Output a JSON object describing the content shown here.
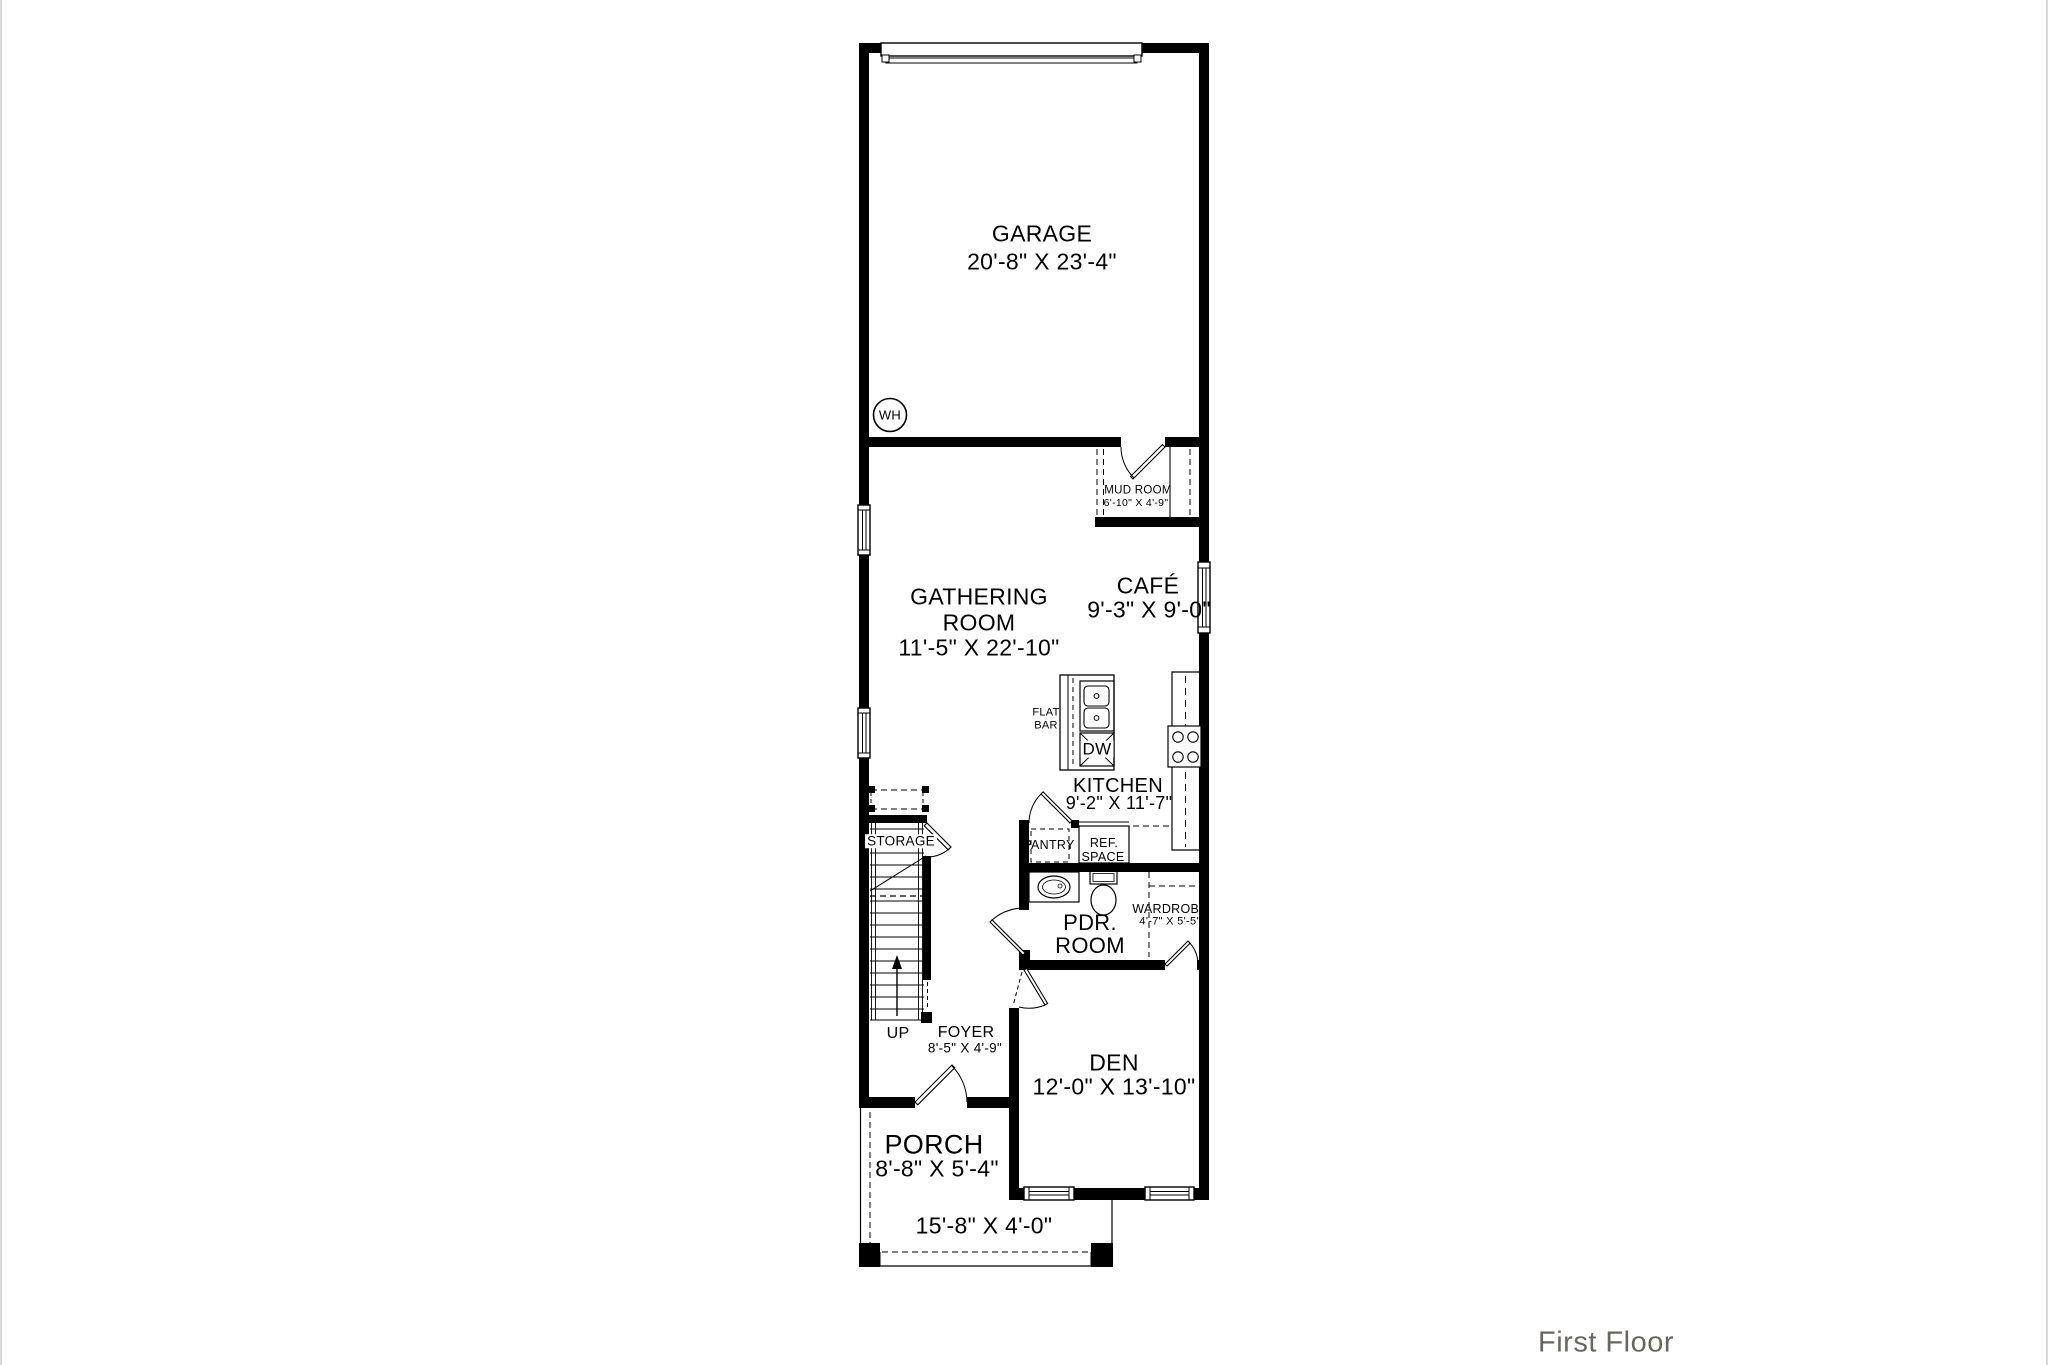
{
  "rooms": {
    "garage": {
      "name": "GARAGE",
      "dims": "20'-8\" X 23'-4\""
    },
    "gathering": {
      "line1": "GATHERING",
      "line2": "ROOM",
      "dims": "11'-5\" X 22'-10\""
    },
    "cafe": {
      "name": "CAFÉ",
      "dims": "9'-3\" X 9'-0\""
    },
    "mud_room": {
      "name": "MUD ROOM",
      "dims": "6'-10\" X 4'-9\""
    },
    "kitchen": {
      "name": "KITCHEN",
      "dims": "9'-2\" X 11'-7\""
    },
    "flat_bar": {
      "line1": "FLAT",
      "line2": "BAR"
    },
    "pantry": {
      "name": "PANTRY"
    },
    "ref_space": {
      "line1": "REF.",
      "line2": "SPACE"
    },
    "pdr_room": {
      "line1": "PDR.",
      "line2": "ROOM"
    },
    "wardrobe": {
      "name": "WARDROBE",
      "dims": "4'-7\" X 5'-5\""
    },
    "storage": {
      "name": "STORAGE"
    },
    "foyer": {
      "name": "FOYER",
      "dims": "8'-5\" X 4'-9\""
    },
    "den": {
      "name": "DEN",
      "dims": "12'-0\" X 13'-10\""
    },
    "porch": {
      "name": "PORCH",
      "dims": "8'-8\" X 5'-4\""
    },
    "stoop": {
      "dims": "15'-8\" X 4'-0\""
    }
  },
  "markers": {
    "up": "UP",
    "dw": "DW",
    "wh": "WH"
  },
  "footer": {
    "label": "First Floor"
  },
  "colors": {
    "wall": "#000000",
    "label": "#000000",
    "footer_text": "#696661",
    "edge_border": "#d9d9d9"
  }
}
